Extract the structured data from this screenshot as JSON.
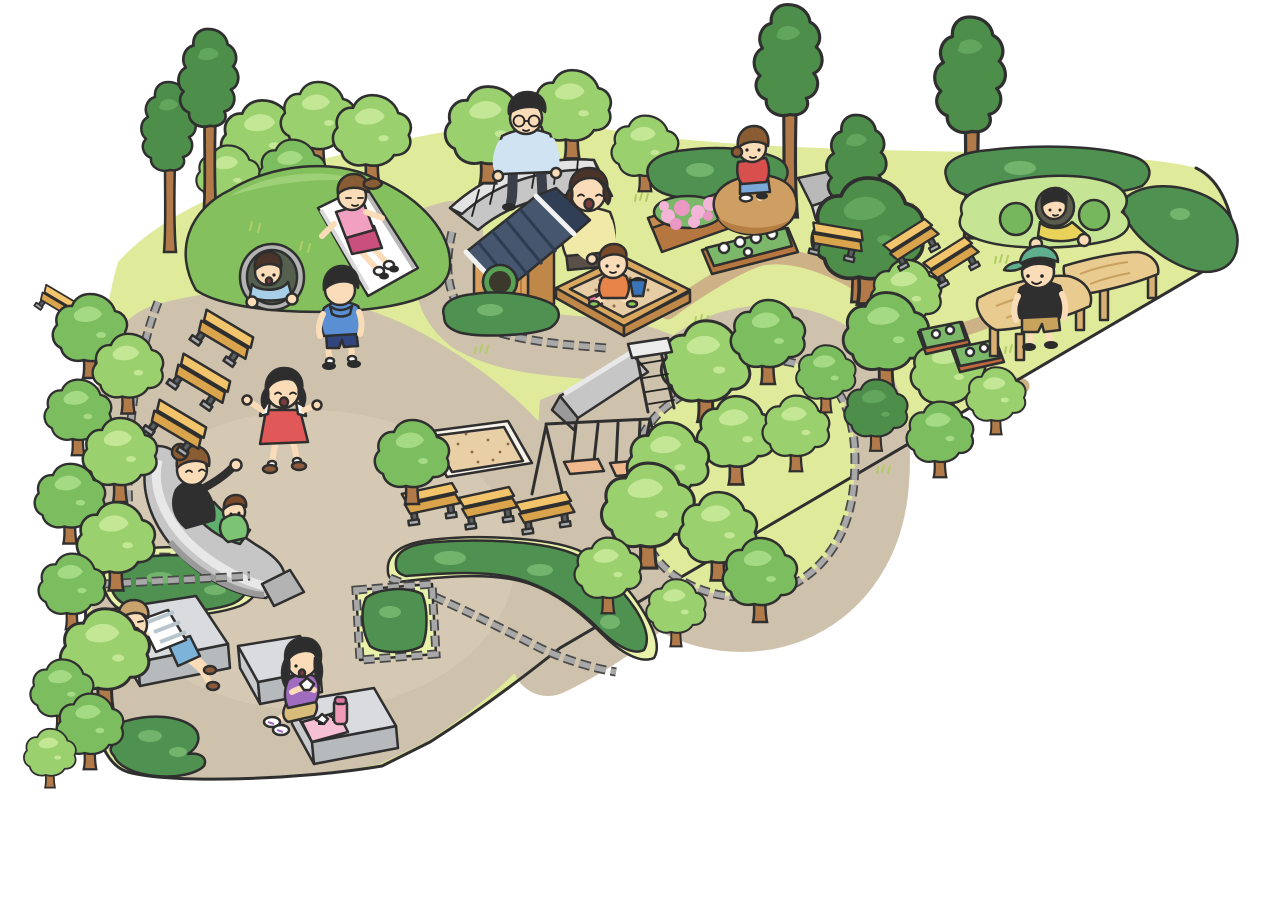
{
  "illustration": {
    "label": "illustrated-park-playground-map",
    "style": "cartoon isometric park illustration, no text"
  },
  "palette": {
    "out": "#2f2f2f",
    "grass": "#dfeb9a",
    "tuft": "#b2cc66",
    "path": "#cfc2ad",
    "pathHi": "#dbcfba",
    "trail": "#cdb287",
    "stoneD": "#4a4a4a",
    "stoneL": "#a8a8a8",
    "treeL": "#9ad06e",
    "treeLh": "#c3e795",
    "treeM": "#7cbd5f",
    "treeMh": "#a5da84",
    "treeD": "#4d8f4a",
    "treeDh": "#62a55c",
    "trunk": "#b17a48",
    "hedge": "#4e9150",
    "hedgeH": "#72b46c",
    "hill": "#84c05e",
    "hillH": "#9ed077",
    "ringGray": "#b3b3b3",
    "holeDark": "#55604f",
    "white": "#ffffff",
    "benchTop": "#f2c46c",
    "benchSide": "#d9a44c",
    "benchLeg": "#5a5f63",
    "benchFoot": "#a9adb1",
    "platTop": "#d9dbde",
    "platSide": "#b7babd",
    "platLeft": "#c8cacd",
    "slideGray": "#c6c6c6",
    "slideDark": "#9a9a9a",
    "slideLite": "#e8e8e8",
    "roofA": "#46566f",
    "roofB": "#303f56",
    "roofLine": "#2e3c52",
    "woodF": "#d8a05c",
    "woodS": "#c08848",
    "woodL": "#b57a3e",
    "winRing": "#58a054",
    "winDark": "#3b382c",
    "rimWood": "#d9a85e",
    "sand": "#e6cda5",
    "sandDot": "#8a6a4a",
    "pitSand": "#e8cfa5",
    "rock": "#cf9e62",
    "rockD": "#b57e42",
    "wall": "#c6c6c6",
    "wallHi": "#e3e3e3",
    "pink": "#f3b5d7",
    "pinkD": "#ea97c4",
    "planter": "#b5773f",
    "planterL": "#c98a4e",
    "terra": "#c0683f",
    "mound": "#c6e594",
    "moundHole": "#76b65c",
    "skin": "#fbdcb8",
    "hairK": "#2d2d2d",
    "hairBr": "#8a5c33",
    "hairDk": "#4a342a",
    "hairLt": "#caa36c",
    "blueLt": "#a8cfe8",
    "blueHood": "#5b8fd4",
    "navy": "#32457c",
    "pinkShirt": "#f2a0c0",
    "magenta": "#c94f7c",
    "manShirt": "#cfe3f2",
    "manPants": "#3a3f4a",
    "yellowTop": "#f0e9a8",
    "orange": "#e8834a",
    "bucket": "#3a74b8",
    "red": "#d8504e",
    "blueShorts": "#7aa8d8",
    "dressRed": "#e05858",
    "black": "#2f2f2f",
    "greenPants": "#5fae6e",
    "greenKid": "#7cc473",
    "stripe": "#b9c5cd",
    "ltblueShorts": "#7db3d8",
    "shoeBr": "#8a5a3a",
    "purple": "#a06cc0",
    "khaki": "#d8bc7a",
    "thermos": "#f09ab8",
    "thermosCap": "#e0759e",
    "napkin": "#f5c0d4",
    "capTeal": "#5fae8e",
    "khakiShorts": "#c8a35c",
    "yellowShirt": "#e8d25a",
    "tableTop": "#e9cb90",
    "tableGrain": "#c9a05f",
    "tableLeg": "#d9b074",
    "seat": "#f0b98d",
    "sock": "#ffffff",
    "shoe": "#2b2b2b"
  },
  "scene": {
    "people": [
      {
        "id": "boy-in-hill-tunnel",
        "desc": "boy in light blue shirt crawling out of hill tunnel"
      },
      {
        "id": "girl-on-hill-slide",
        "desc": "girl in pink shirt sliding down white hill slide"
      },
      {
        "id": "boy-walking",
        "desc": "boy in blue hoodie walking on path"
      },
      {
        "id": "man-on-stone-bench",
        "desc": "man with glasses sitting on curved stone wall"
      },
      {
        "id": "mother-at-sandbox",
        "desc": "mother in yellow kneeling at sandbox"
      },
      {
        "id": "toddler-in-sandbox",
        "desc": "toddler in orange playing with bucket"
      },
      {
        "id": "girl-on-rock",
        "desc": "girl in red squatting on boulder"
      },
      {
        "id": "girl-running",
        "desc": "girl in red dress running"
      },
      {
        "id": "mother-and-toddler-on-slide",
        "desc": "mother with toddler on wide gray slide"
      },
      {
        "id": "boy-lying-on-platform",
        "desc": "boy in striped shirt lying on stone platform"
      },
      {
        "id": "girl-picnicking",
        "desc": "girl eating rice balls on platform with thermos"
      },
      {
        "id": "boy-in-play-mound",
        "desc": "boy in yellow peeking from play mound hole"
      },
      {
        "id": "boy-at-picnic-tables",
        "desc": "boy with teal cap by wooden tables"
      }
    ],
    "trees": [
      {
        "x": 262,
        "y": 140,
        "s": 1.1,
        "v": "L",
        "layer": "back"
      },
      {
        "x": 318,
        "y": 118,
        "s": 1.0,
        "v": "L",
        "layer": "back"
      },
      {
        "x": 372,
        "y": 133,
        "s": 1.05,
        "v": "L",
        "layer": "back"
      },
      {
        "x": 292,
        "y": 172,
        "s": 0.9,
        "v": "M",
        "layer": "back"
      },
      {
        "x": 228,
        "y": 176,
        "s": 0.85,
        "v": "L",
        "layer": "back"
      },
      {
        "x": 170,
        "y": 152,
        "s": 1.0,
        "v": "T",
        "layer": "back"
      },
      {
        "x": 210,
        "y": 106,
        "s": 1.1,
        "v": "T",
        "layer": "back"
      },
      {
        "x": 488,
        "y": 128,
        "s": 1.15,
        "v": "L",
        "layer": "back"
      },
      {
        "x": 572,
        "y": 108,
        "s": 1.05,
        "v": "L",
        "layer": "back"
      },
      {
        "x": 645,
        "y": 148,
        "s": 0.9,
        "v": "L",
        "layer": "back"
      },
      {
        "x": 790,
        "y": 92,
        "s": 1.25,
        "v": "T",
        "layer": "back"
      },
      {
        "x": 858,
        "y": 192,
        "s": 1.1,
        "v": "T",
        "layer": "back"
      },
      {
        "x": 972,
        "y": 108,
        "s": 1.3,
        "v": "T",
        "layer": "back"
      },
      {
        "x": 868,
        "y": 232,
        "s": 1.5,
        "v": "D",
        "layer": "back"
      },
      {
        "x": 906,
        "y": 294,
        "s": 0.95,
        "v": "L",
        "layer": "back"
      },
      {
        "x": 886,
        "y": 334,
        "s": 1.15,
        "v": "M",
        "layer": "back"
      },
      {
        "x": 948,
        "y": 372,
        "s": 1.0,
        "v": "L",
        "layer": "back"
      },
      {
        "x": 876,
        "y": 410,
        "s": 0.85,
        "v": "D",
        "layer": "back"
      },
      {
        "x": 940,
        "y": 434,
        "s": 0.9,
        "v": "M",
        "layer": "back"
      },
      {
        "x": 996,
        "y": 396,
        "s": 0.8,
        "v": "L",
        "layer": "back"
      },
      {
        "x": 706,
        "y": 364,
        "s": 1.2,
        "v": "L",
        "layer": "back"
      },
      {
        "x": 768,
        "y": 336,
        "s": 1.0,
        "v": "M",
        "layer": "back"
      },
      {
        "x": 736,
        "y": 434,
        "s": 1.05,
        "v": "L",
        "layer": "back"
      },
      {
        "x": 796,
        "y": 428,
        "s": 0.9,
        "v": "L",
        "layer": "back"
      },
      {
        "x": 826,
        "y": 374,
        "s": 0.8,
        "v": "M",
        "layer": "back"
      },
      {
        "x": 90,
        "y": 330,
        "s": 1.0,
        "v": "M",
        "layer": "front"
      },
      {
        "x": 128,
        "y": 368,
        "s": 0.95,
        "v": "L",
        "layer": "front"
      },
      {
        "x": 78,
        "y": 412,
        "s": 0.9,
        "v": "M",
        "layer": "front"
      },
      {
        "x": 120,
        "y": 454,
        "s": 1.0,
        "v": "L",
        "layer": "front"
      },
      {
        "x": 70,
        "y": 498,
        "s": 0.95,
        "v": "M",
        "layer": "front"
      },
      {
        "x": 116,
        "y": 540,
        "s": 1.05,
        "v": "L",
        "layer": "front"
      },
      {
        "x": 72,
        "y": 586,
        "s": 0.9,
        "v": "M",
        "layer": "front"
      },
      {
        "x": 105,
        "y": 652,
        "s": 1.2,
        "v": "L",
        "layer": "front"
      },
      {
        "x": 62,
        "y": 690,
        "s": 0.85,
        "v": "M",
        "layer": "front"
      },
      {
        "x": 90,
        "y": 726,
        "s": 0.9,
        "v": "M",
        "layer": "front"
      },
      {
        "x": 50,
        "y": 754,
        "s": 0.7,
        "v": "L",
        "layer": "front"
      },
      {
        "x": 412,
        "y": 456,
        "s": 1.0,
        "v": "M",
        "layer": "front"
      },
      {
        "x": 668,
        "y": 462,
        "s": 1.1,
        "v": "L",
        "layer": "front"
      },
      {
        "x": 648,
        "y": 508,
        "s": 1.25,
        "v": "L",
        "layer": "front"
      },
      {
        "x": 718,
        "y": 530,
        "s": 1.05,
        "v": "L",
        "layer": "front"
      },
      {
        "x": 760,
        "y": 574,
        "s": 1.0,
        "v": "M",
        "layer": "front"
      },
      {
        "x": 608,
        "y": 570,
        "s": 0.9,
        "v": "L",
        "layer": "front"
      },
      {
        "x": 676,
        "y": 608,
        "s": 0.8,
        "v": "L",
        "layer": "front"
      }
    ],
    "benches": [
      {
        "x": 57,
        "y": 306,
        "r": 35,
        "s": 0.7
      },
      {
        "x": 222,
        "y": 340,
        "r": 35,
        "s": 1
      },
      {
        "x": 199,
        "y": 384,
        "r": 35,
        "s": 1
      },
      {
        "x": 175,
        "y": 430,
        "r": 35,
        "s": 1
      },
      {
        "x": 432,
        "y": 505,
        "r": -8,
        "s": 0.95
      },
      {
        "x": 489,
        "y": 509,
        "r": -8,
        "s": 0.95
      },
      {
        "x": 546,
        "y": 514,
        "r": -8,
        "s": 0.95
      },
      {
        "x": 836,
        "y": 243,
        "r": 14,
        "s": 0.9
      },
      {
        "x": 914,
        "y": 245,
        "r": -28,
        "s": 0.9
      },
      {
        "x": 954,
        "y": 263,
        "r": -28,
        "s": 0.9
      }
    ],
    "tufts": [
      {
        "x": 255,
        "y": 232
      },
      {
        "x": 300,
        "y": 252
      },
      {
        "x": 330,
        "y": 224
      },
      {
        "x": 560,
        "y": 182
      },
      {
        "x": 640,
        "y": 200
      },
      {
        "x": 700,
        "y": 322
      },
      {
        "x": 780,
        "y": 250
      },
      {
        "x": 870,
        "y": 262
      },
      {
        "x": 930,
        "y": 302
      },
      {
        "x": 1000,
        "y": 262
      },
      {
        "x": 820,
        "y": 432
      },
      {
        "x": 882,
        "y": 472
      },
      {
        "x": 1010,
        "y": 352
      },
      {
        "x": 480,
        "y": 352
      },
      {
        "x": 905,
        "y": 210
      }
    ]
  }
}
